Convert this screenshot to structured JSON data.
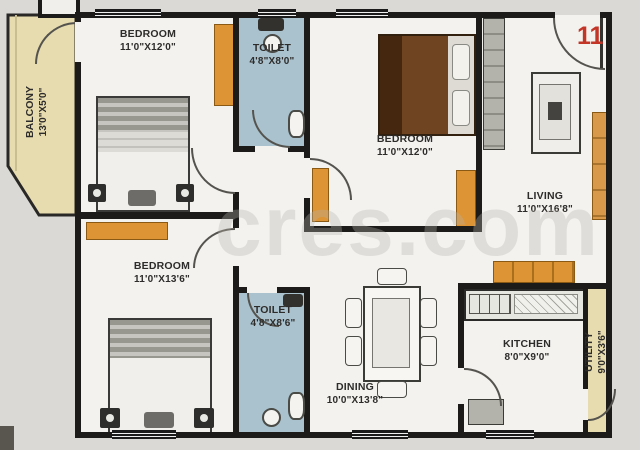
{
  "watermark": "cres.com",
  "unit_number": "11",
  "rooms": {
    "balcony": {
      "name": "BALCONY",
      "dims": "13'0\"X5'0\""
    },
    "bedroom_top_left": {
      "name": "BEDROOM",
      "dims": "11'0\"X12'0\""
    },
    "toilet_top": {
      "name": "TOILET",
      "dims": "4'8\"X8'0\""
    },
    "bedroom_middle": {
      "name": "BEDROOM",
      "dims": "11'0\"X12'0\""
    },
    "living": {
      "name": "LIVING",
      "dims": "11'0\"X16'8\""
    },
    "bedroom_bottom_left": {
      "name": "BEDROOM",
      "dims": "11'0\"X13'6\""
    },
    "toilet_bottom": {
      "name": "TOILET",
      "dims": "4'8\"X8'6\""
    },
    "dining": {
      "name": "DINING",
      "dims": "10'0\"X13'8\""
    },
    "kitchen": {
      "name": "KITCHEN",
      "dims": "8'0\"X9'0\""
    },
    "utility": {
      "name": "UTILITY",
      "dims": "9'0\"X3'6\""
    }
  },
  "colors": {
    "wall": "#1d1b1a",
    "floor": "#f3f2ef",
    "toilet_floor": "#a9c2ce",
    "balcony_floor": "#e7dcb0",
    "furniture_orange": "#dc9434",
    "unit_number_red": "#c23527"
  }
}
